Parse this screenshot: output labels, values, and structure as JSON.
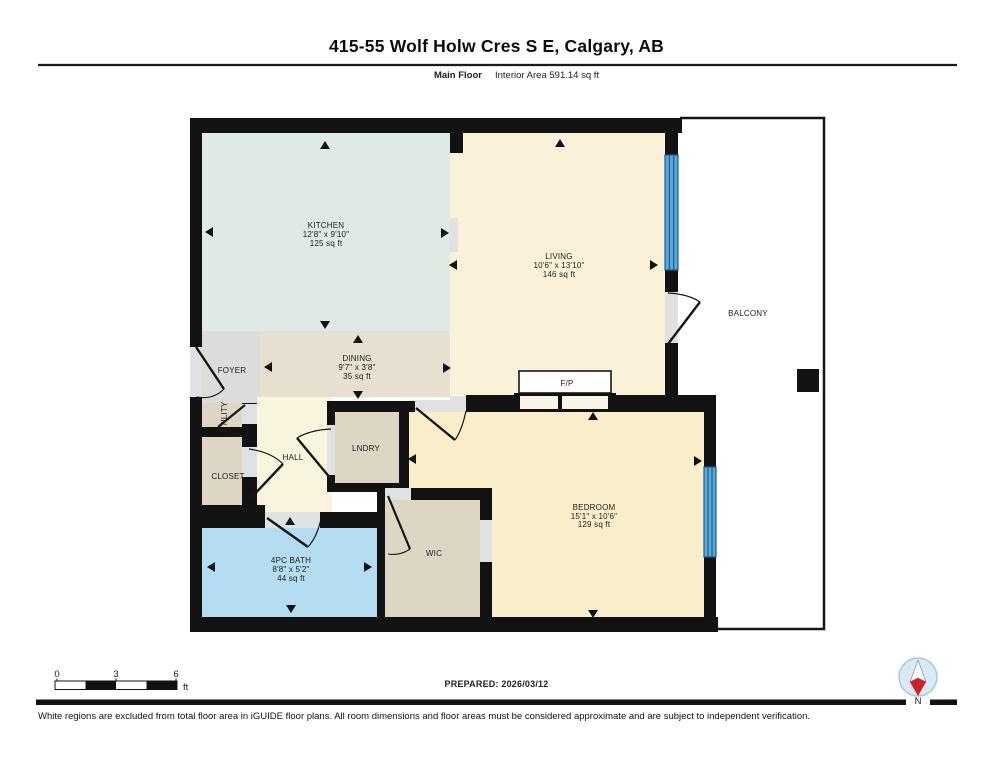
{
  "header": {
    "title": "415-55 Wolf Holw Cres S E, Calgary, AB",
    "floor_label": "Main Floor",
    "area_label": "Interior Area 591.14 sq ft"
  },
  "rooms": {
    "kitchen": {
      "name": "KITCHEN",
      "dims": "12'8\" x 9'10\"",
      "area": "125 sq ft"
    },
    "living": {
      "name": "LIVING",
      "dims": "10'6\" x 13'10\"",
      "area": "146 sq ft"
    },
    "dining": {
      "name": "DINING",
      "dims": "9'7\" x 3'8\"",
      "area": "35 sq ft"
    },
    "bedroom": {
      "name": "BEDROOM",
      "dims": "15'1\" x 10'6\"",
      "area": "129 sq ft"
    },
    "bath": {
      "name": "4PC BATH",
      "dims": "8'8\" x 5'2\"",
      "area": "44 sq ft"
    },
    "foyer": {
      "name": "FOYER"
    },
    "utility": {
      "name": "UTILITY"
    },
    "closet": {
      "name": "CLOSET"
    },
    "hall": {
      "name": "HALL"
    },
    "laundry": {
      "name": "LNDRY"
    },
    "wic": {
      "name": "WIC"
    },
    "balcony": {
      "name": "BALCONY"
    },
    "fireplace": {
      "name": "F/P"
    }
  },
  "scale_bar": {
    "tick0": "0",
    "tick3": "3",
    "tick6": "6",
    "unit": "ft"
  },
  "footer": {
    "prepared": "PREPARED: 2026/03/12",
    "disclaimer": "White regions are excluded from total floor area in iGUIDE floor plans. All room dimensions and floor areas must be considered approximate and are subject to independent verification.",
    "north": "N"
  },
  "colors": {
    "wall": "#121212",
    "kitchen": "#deeae3",
    "living": "#faf2d8",
    "dining": "#e7e0d0",
    "foyer": "#dcdcda",
    "hall": "#f9f4de",
    "bedroom": "#faefca",
    "wic": "#ded6c5",
    "closet": "#ded6c5",
    "laundry": "#ded6c5",
    "utility": "#ded6c5",
    "bath": "#b4dcf3",
    "window": "#5aa8d8",
    "window_stripe": "#1d5d90",
    "opening": "#e0e1e3",
    "north_red": "#cf2027"
  }
}
